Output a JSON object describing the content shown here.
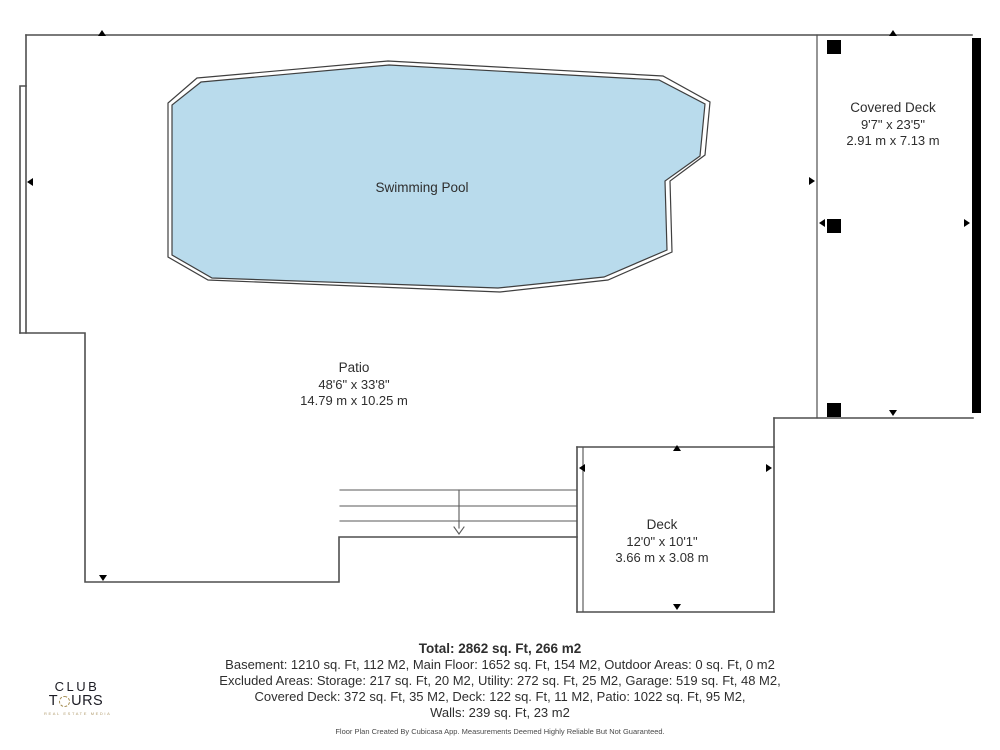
{
  "plan": {
    "rooms": {
      "swimming_pool": {
        "label": "Swimming Pool"
      },
      "covered_deck": {
        "label": "Covered Deck",
        "dimensions_imperial": "9'7\" x 23'5\"",
        "dimensions_metric": "2.91 m x 7.13 m"
      },
      "patio": {
        "label": "Patio",
        "dimensions_imperial": "48'6\" x 33'8\"",
        "dimensions_metric": "14.79 m x 10.25 m"
      },
      "deck": {
        "label": "Deck",
        "dimensions_imperial": "12'0\" x 10'1\"",
        "dimensions_metric": "3.66 m x 3.08 m"
      }
    }
  },
  "summary": {
    "total": "Total: 2862 sq. Ft, 266 m2",
    "line1": "Basement: 1210 sq. Ft, 112 M2, Main Floor: 1652 sq. Ft, 154 M2, Outdoor Areas: 0 sq. Ft, 0 m2",
    "line2": "Excluded Areas: Storage: 217 sq. Ft, 20 M2, Utility: 272 sq. Ft, 25 M2, Garage: 519 sq. Ft, 48 M2,",
    "line3": "Covered Deck: 372 sq. Ft, 35 M2, Deck: 122 sq. Ft, 11 M2, Patio: 1022 sq. Ft, 95 M2,",
    "line4": "Walls: 239 sq. Ft, 23 m2"
  },
  "disclaimer": "Floor Plan Created By Cubicasa App. Measurements Deemed Highly Reliable But Not Guaranteed.",
  "logo": {
    "line1": "CLUB",
    "line2_before_o": "T",
    "line2_after_o": "URS",
    "tagline": "REAL ESTATE MEDIA"
  },
  "colors": {
    "pool_fill": "#b9dbec",
    "line": "#4f4f4f",
    "wall_black": "#000000",
    "logo_gold": "#a58e54",
    "text": "#2e2e2e"
  }
}
